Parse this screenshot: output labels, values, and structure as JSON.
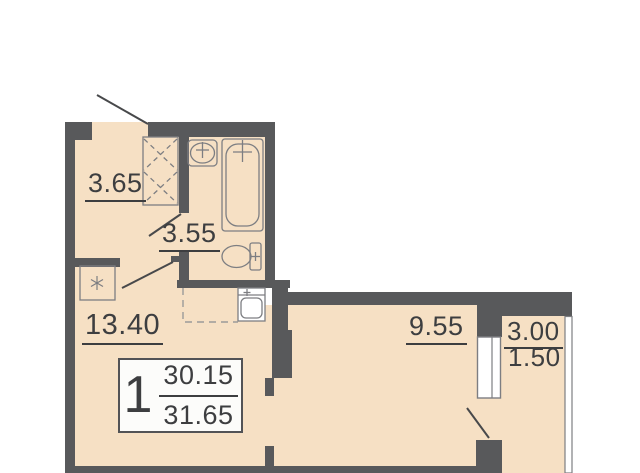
{
  "apartment": {
    "number": "1",
    "area_main": "30.15",
    "area_total": "31.65"
  },
  "rooms": {
    "entry": {
      "area": "3.65"
    },
    "hall": {
      "area": "3.55"
    },
    "living_kitchen": {
      "area": "13.40"
    },
    "bedroom": {
      "area": "9.55"
    },
    "balcony": {
      "area": "3.00",
      "area_reduced": "1.50"
    }
  },
  "colors": {
    "floor": "#f6e0c4",
    "wall": "#58595b",
    "fixture_line": "#7d7e82",
    "door_line": "#48494b",
    "text": "#3d3e40",
    "background": "#ffffff"
  }
}
